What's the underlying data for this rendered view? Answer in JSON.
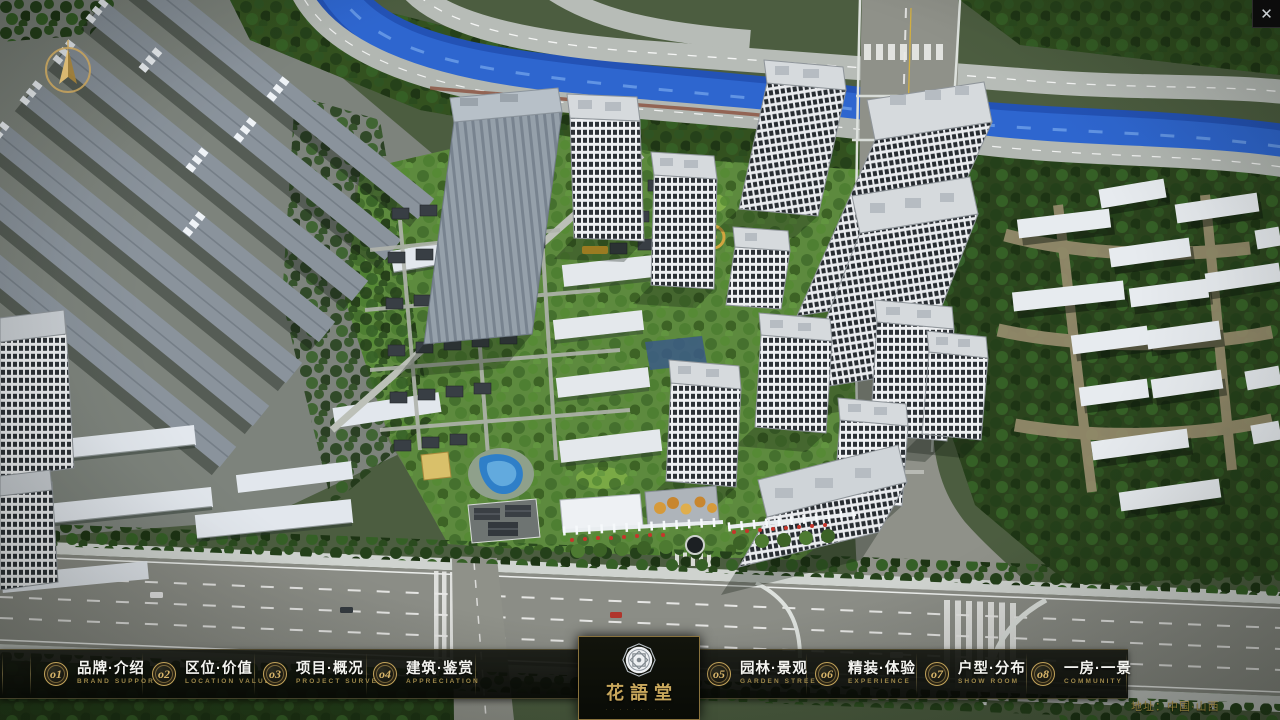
{
  "window": {
    "close_glyph": "✕"
  },
  "logo": {
    "title": "花語堂",
    "subtitle": "· · · · · · · · · ·"
  },
  "nav": {
    "items": [
      {
        "num": "o1",
        "label": "品牌·介绍",
        "sub": "BRAND SUPPORT"
      },
      {
        "num": "o2",
        "label": "区位·价值",
        "sub": "LOCATION VALUE"
      },
      {
        "num": "o3",
        "label": "项目·概况",
        "sub": "PROJECT SURVEY"
      },
      {
        "num": "o4",
        "label": "建筑·鉴赏",
        "sub": "APPRECIATION"
      },
      {
        "num": "o5",
        "label": "园林·景观",
        "sub": "GARDEN STREET"
      },
      {
        "num": "o6",
        "label": "精装·体验",
        "sub": "EXPERIENCE"
      },
      {
        "num": "o7",
        "label": "户型·分布",
        "sub": "SHOW ROOM"
      },
      {
        "num": "o8",
        "label": "一房·一景",
        "sub": "COMMUNITY"
      }
    ]
  },
  "footer": {
    "address": "地址：中国·山西"
  },
  "colors": {
    "gold": "#c9a85c",
    "bar_bg": "#0b0d08",
    "river_blue": "#2d63c4"
  }
}
